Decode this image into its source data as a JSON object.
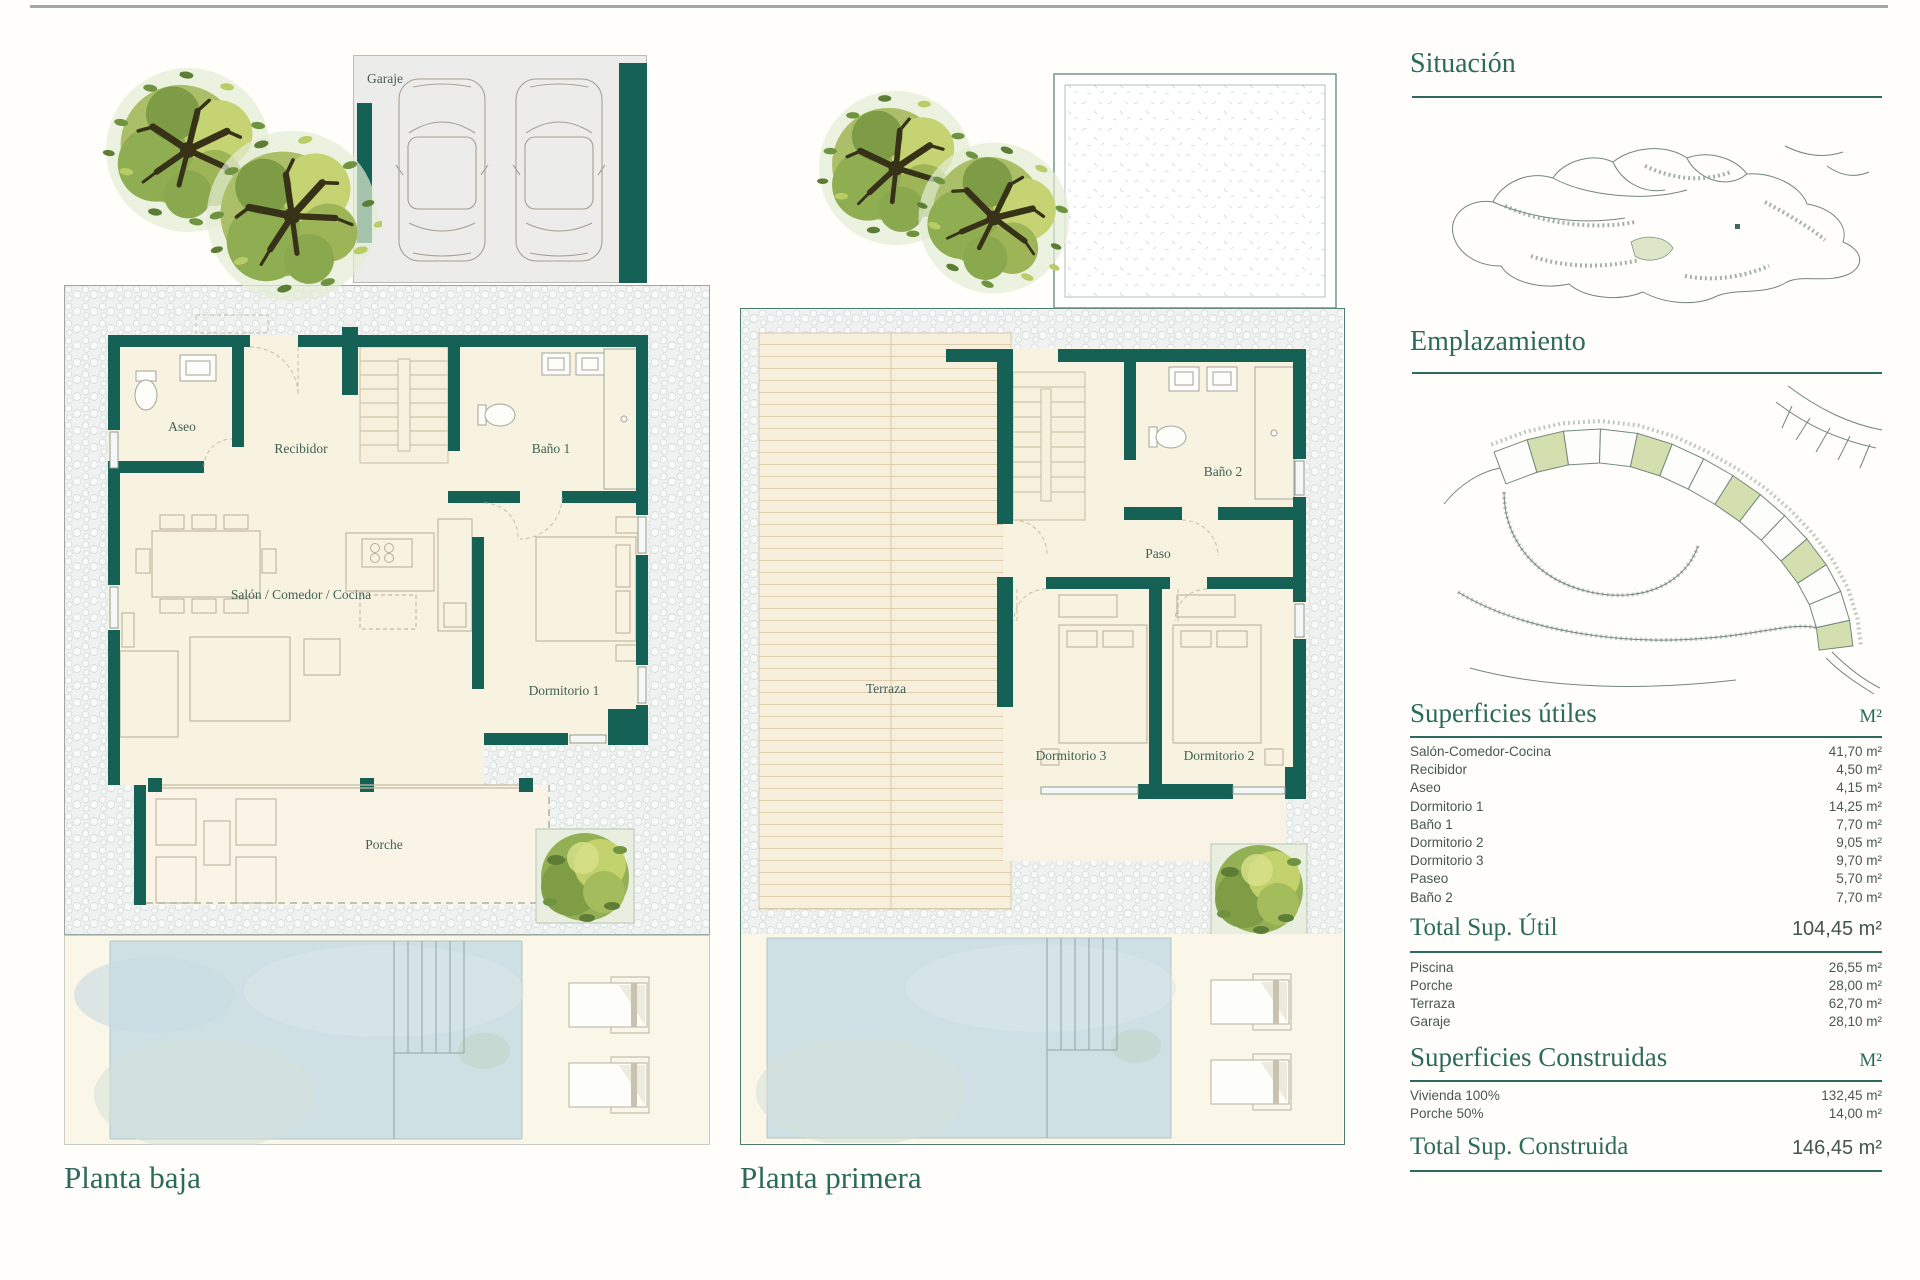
{
  "titles": {
    "planta_baja": "Planta baja",
    "planta_primera": "Planta primera",
    "situacion": "Situación",
    "emplazamiento": "Emplazamiento"
  },
  "plan_baja": {
    "garaje": "Garaje",
    "aseo": "Aseo",
    "recibidor": "Recibidor",
    "bano1": "Baño 1",
    "salon": "Salón / Comedor / Cocina",
    "dormitorio1": "Dormitorio 1",
    "porche": "Porche"
  },
  "plan_primera": {
    "terraza": "Terraza",
    "bano2": "Baño 2",
    "paso": "Paso",
    "dormitorio3": "Dormitorio 3",
    "dormitorio2": "Dormitorio 2"
  },
  "superficies_utiles": {
    "title": "Superficies útiles",
    "unit": "M²",
    "rows": [
      {
        "label": "Salón-Comedor-Cocina",
        "value": "41,70 m²"
      },
      {
        "label": "Recibidor",
        "value": "4,50 m²"
      },
      {
        "label": "Aseo",
        "value": "4,15 m²"
      },
      {
        "label": "Dormitorio 1",
        "value": "14,25 m²"
      },
      {
        "label": "Baño 1",
        "value": "7,70 m²"
      },
      {
        "label": "Dormitorio 2",
        "value": "9,05 m²"
      },
      {
        "label": "Dormitorio 3",
        "value": "9,70 m²"
      },
      {
        "label": "Paseo",
        "value": "5,70 m²"
      },
      {
        "label": "Baño 2",
        "value": "7,70 m²"
      }
    ],
    "total_label": "Total Sup. Útil",
    "total_value": "104,45 m²",
    "extra_rows": [
      {
        "label": "Piscina",
        "value": "26,55 m²"
      },
      {
        "label": "Porche",
        "value": "28,00 m²"
      },
      {
        "label": "Terraza",
        "value": "62,70 m²"
      },
      {
        "label": "Garaje",
        "value": "28,10 m²"
      }
    ]
  },
  "superficies_construidas": {
    "title": "Superficies Construidas",
    "unit": "M²",
    "rows": [
      {
        "label": "Vivienda 100%",
        "value": "132,45 m²"
      },
      {
        "label": "Porche 50%",
        "value": "14,00 m²"
      }
    ],
    "total_label": "Total Sup. Construida",
    "total_value": "146,45 m²"
  },
  "colors": {
    "wall_teal": "#156156",
    "heading_green": "#2c6a5c",
    "body_text": "#47594f",
    "room_cream": "#f8f2e0",
    "deck_cream": "#f7efdb",
    "pool_blue": "#cfe0e5",
    "plot_background": "#eef1f0",
    "tree_green": "#8fae52",
    "plot_highlight_green": "#d3dfae",
    "border_teal": "#4c7a6e"
  }
}
